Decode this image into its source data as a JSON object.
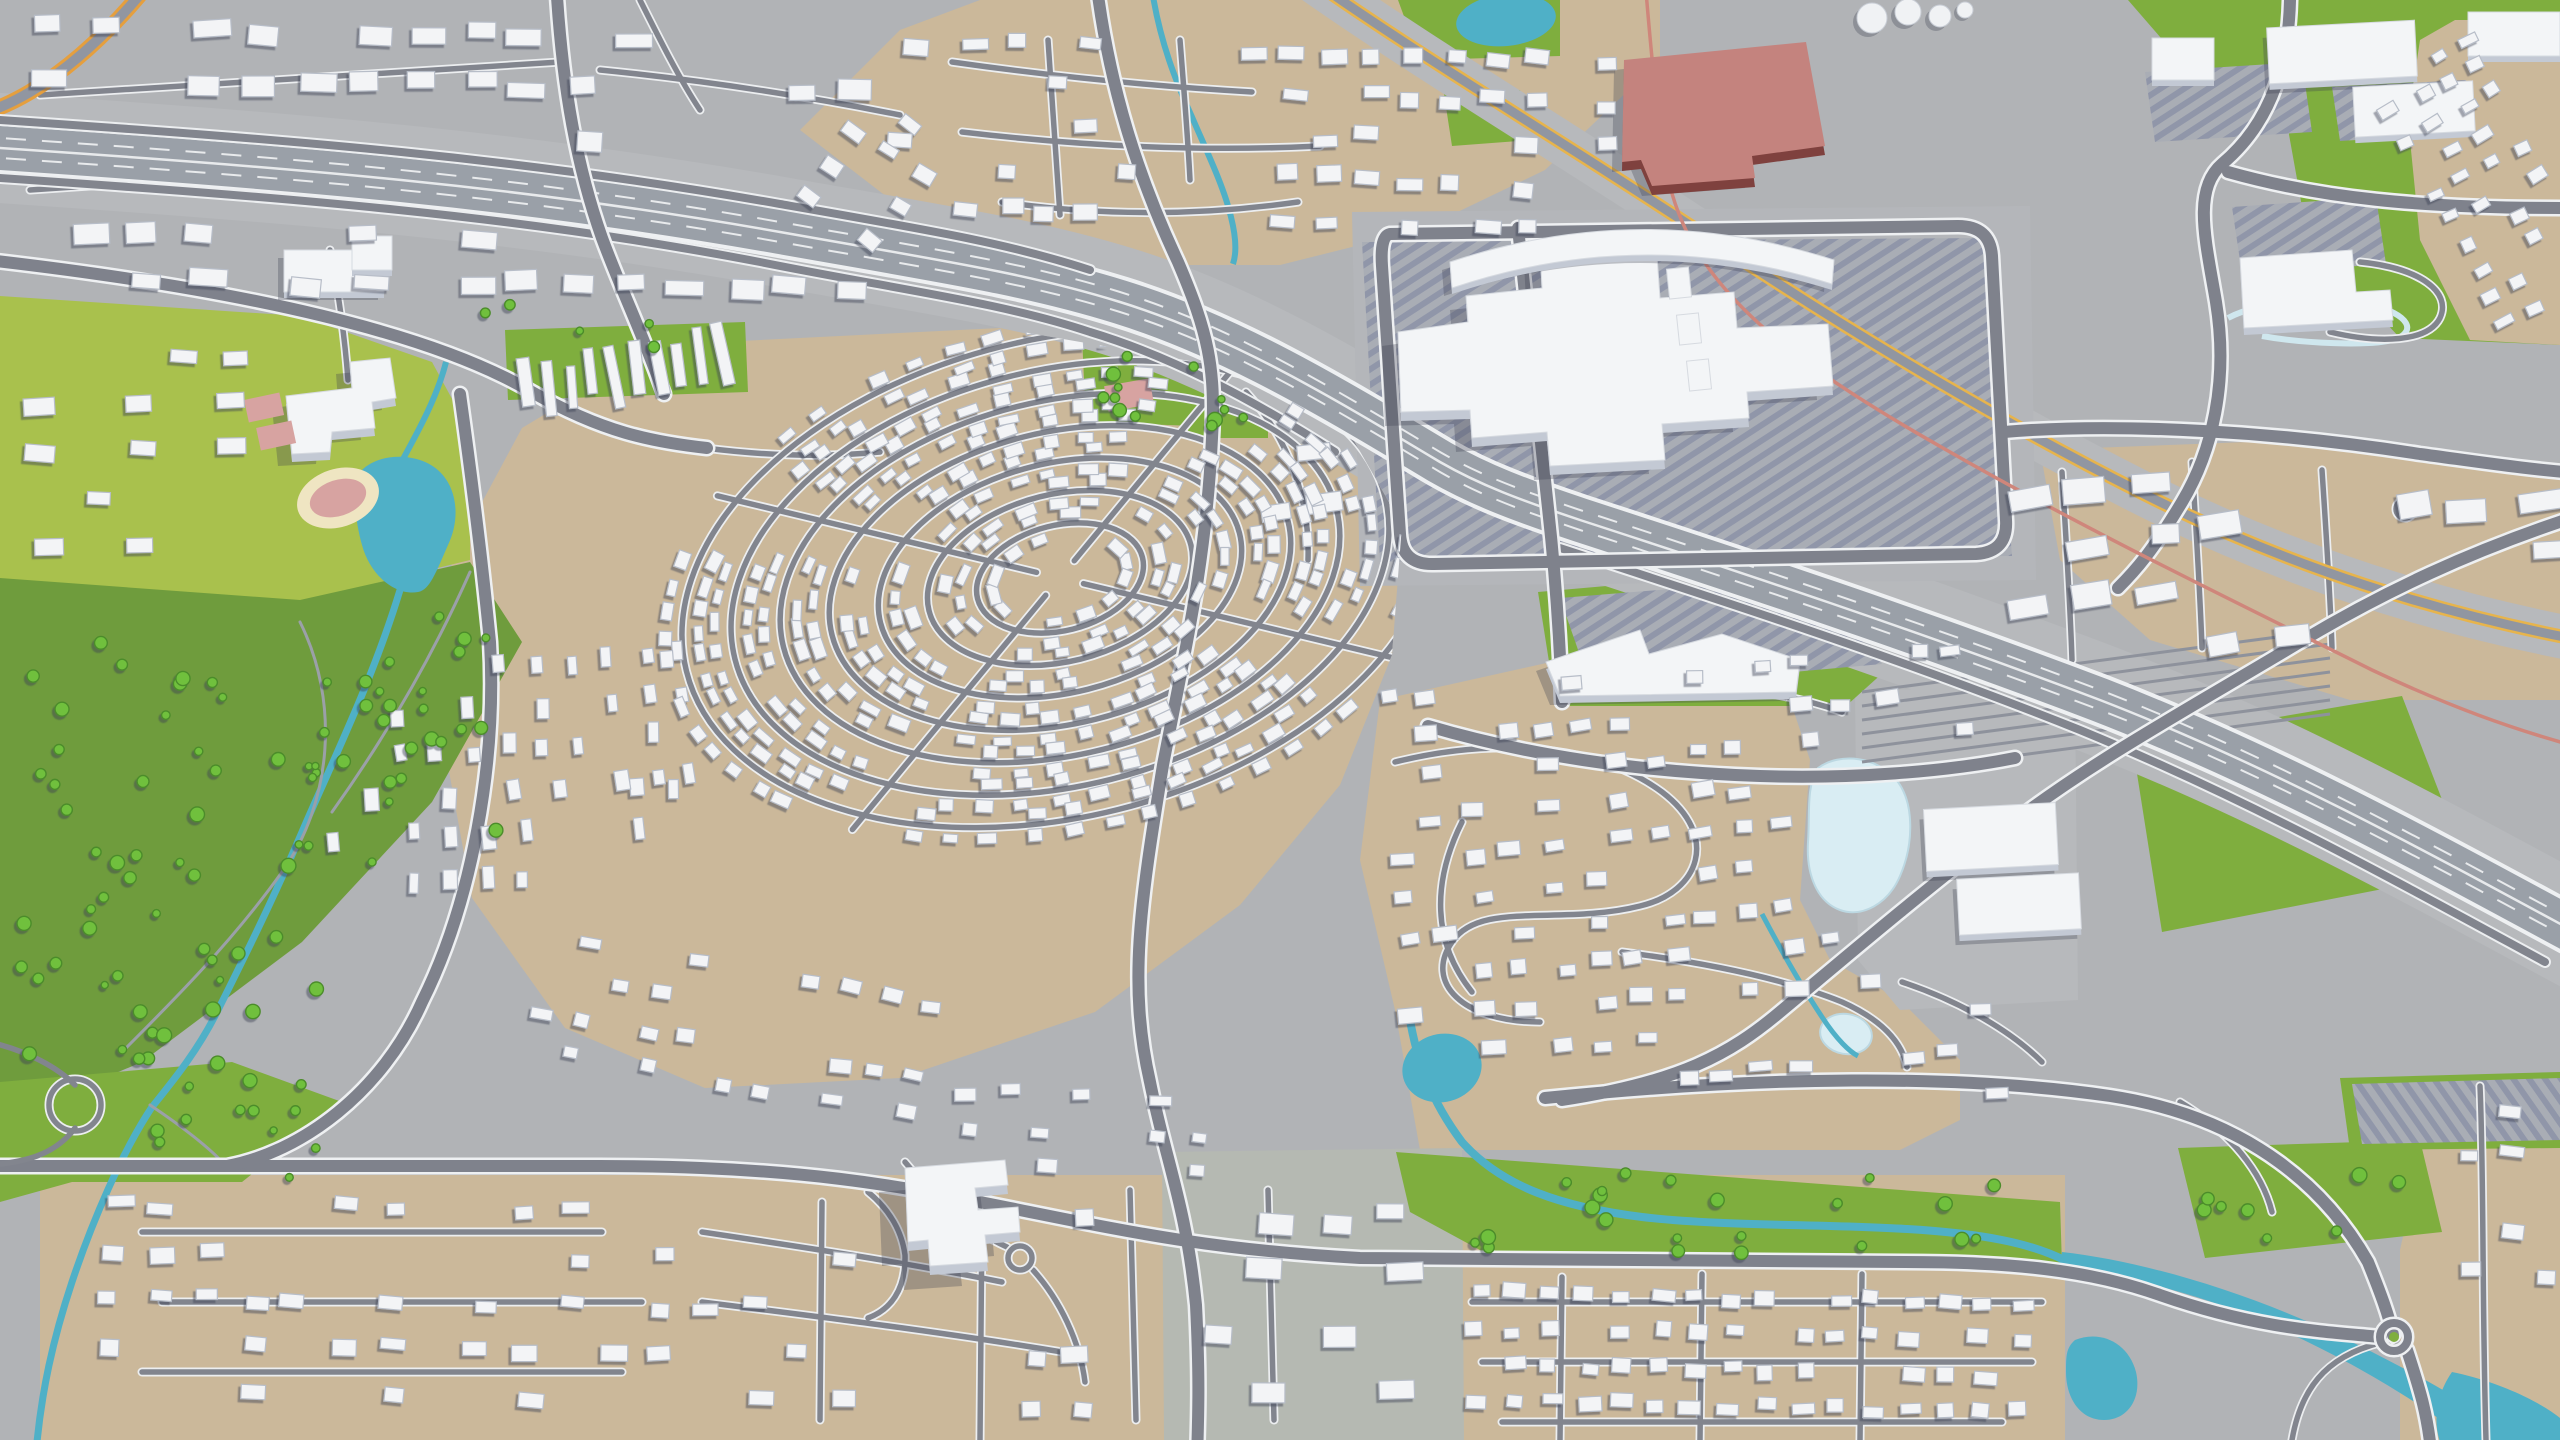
{
  "meta": {
    "description": "Aerial 3D render of a suburban city model: white extruded buildings, tan residential districts, a concentric-ring subdivision, green parks with ponds and streams, a diagonal multi-lane highway, rail corridor, shopping mall with striped parking lots and a red factory building",
    "width": 2560,
    "height": 1440,
    "view": "isometric-aerial"
  },
  "palette": {
    "ground": "#b1b3b6",
    "ground_cool": "#b5b9b2",
    "campus_pad": "#b4b6ba",
    "tan": "#cbb89a",
    "green_bright": "#a9c14d",
    "green_mid": "#7fae3e",
    "green_dark": "#6f9c3d",
    "tree": "#6fc03d",
    "tree_edge": "#4c8c2b",
    "water": "#4fb0c7",
    "water_pale": "#d9edf3",
    "road": "#7f828c",
    "road_casing": "#eef0f2",
    "highway_surface": "#9aa0a8",
    "yellow_stripe": "#e7b44c",
    "orange_stripe": "#e59f3e",
    "rail": "#cf867b",
    "building_top": "#f3f5f7",
    "building_side": "#c3c9d4",
    "red_roof": "#c4837e",
    "red_side": "#7f413e",
    "parking_stripe": "#9096a9",
    "track_ring": "#efe5c2",
    "track_infield": "#d7a3a1"
  },
  "landmarks": [
    "central-mall-building",
    "curved-strip-mall",
    "red-factory",
    "storage-tanks",
    "school-campus-west",
    "running-track",
    "tennis-courts",
    "school-campus-south",
    "warehouse-complex",
    "rail-yard",
    "big-box-stores-northeast",
    "retail-center-south",
    "ring-subdivision",
    "left-park",
    "creek-greenbelt",
    "roundabout-southeast",
    "highway-interchange",
    "top-left-tower-row"
  ],
  "zones": [
    {
      "name": "top-band",
      "x": 950,
      "y": 30,
      "w": 680,
      "h": 225,
      "ang": 2,
      "dx": 40,
      "dy": 42,
      "bw": 20,
      "bh": 13,
      "density": 0.6,
      "holes": [
        [
          1130,
          20,
          120,
          250
        ]
      ]
    },
    {
      "name": "right-suburb",
      "x": 1385,
      "y": 655,
      "w": 600,
      "h": 470,
      "ang": -5,
      "dx": 38,
      "dy": 40,
      "bw": 19,
      "bh": 12,
      "density": 0.62,
      "holes": [
        [
          1790,
          745,
          140,
          185
        ],
        [
          1805,
          985,
          100,
          90
        ],
        [
          1870,
          780,
          120,
          200
        ],
        [
          1385,
          1090,
          610,
          45
        ]
      ]
    },
    {
      "name": "bottom-left-band",
      "x": 90,
      "y": 1190,
      "w": 1060,
      "h": 240,
      "ang": 1,
      "dx": 46,
      "dy": 46,
      "bw": 21,
      "bh": 13,
      "density": 0.42,
      "holes": [
        [
          850,
          1150,
          230,
          175
        ]
      ]
    },
    {
      "name": "bottom-right-band",
      "x": 1460,
      "y": 1280,
      "w": 590,
      "h": 155,
      "ang": 1,
      "dx": 36,
      "dy": 36,
      "bw": 18,
      "bh": 12,
      "density": 0.8,
      "holes": []
    },
    {
      "name": "bottom-mid-blocks",
      "x": 1180,
      "y": 1190,
      "w": 270,
      "h": 240,
      "ang": 0,
      "dx": 62,
      "dy": 56,
      "bw": 30,
      "bh": 18,
      "density": 0.5,
      "holes": []
    },
    {
      "name": "top-right-corner",
      "x": 2420,
      "y": 30,
      "w": 135,
      "h": 300,
      "ang": -28,
      "dx": 33,
      "dy": 30,
      "bw": 15,
      "bh": 10,
      "density": 0.75,
      "holes": []
    },
    {
      "name": "right-edge-south",
      "x": 2445,
      "y": 1095,
      "w": 110,
      "h": 330,
      "ang": 3,
      "dx": 42,
      "dy": 40,
      "bw": 19,
      "bh": 12,
      "density": 0.55,
      "holes": [
        [
          2440,
          1280,
          130,
          170
        ]
      ]
    },
    {
      "name": "top-left-urban",
      "x": 15,
      "y": 10,
      "w": 930,
      "h": 290,
      "ang": 1,
      "dx": 54,
      "dy": 50,
      "bw": 30,
      "bh": 16,
      "density": 0.5,
      "holes": [
        [
          0,
          118,
          560,
          84
        ],
        [
          540,
          162,
          430,
          116
        ]
      ]
    },
    {
      "name": "left-mid-urban",
      "x": 20,
      "y": 335,
      "w": 230,
      "h": 230,
      "ang": 0,
      "dx": 48,
      "dy": 46,
      "bw": 26,
      "bh": 14,
      "density": 0.5,
      "holes": []
    },
    {
      "name": "park-east-strip",
      "x": 455,
      "y": 640,
      "w": 110,
      "h": 370,
      "ang": 88,
      "dx": 42,
      "dy": 38,
      "bw": 18,
      "bh": 11,
      "density": 0.65,
      "holes": []
    },
    {
      "name": "right-offices",
      "x": 2000,
      "y": 440,
      "w": 560,
      "h": 250,
      "ang": -6,
      "dx": 64,
      "dy": 56,
      "bw": 34,
      "bh": 20,
      "density": 0.42,
      "holes": [
        [
          2240,
          370,
          120,
          110
        ]
      ]
    },
    {
      "name": "slab-row",
      "x": 515,
      "y": 336,
      "w": 225,
      "h": 60,
      "ang": -8,
      "dx": 22,
      "dy": 70,
      "bw": 10,
      "bh": 50,
      "density": 1,
      "holes": []
    },
    {
      "name": "ring-west",
      "x": 460,
      "y": 560,
      "w": 160,
      "h": 330,
      "ang": 85,
      "dx": 40,
      "dy": 36,
      "bw": 17,
      "bh": 11,
      "density": 0.55,
      "holes": []
    },
    {
      "name": "ring-south",
      "x": 520,
      "y": 950,
      "w": 420,
      "h": 160,
      "ang": 10,
      "dx": 38,
      "dy": 38,
      "bw": 17,
      "bh": 11,
      "density": 0.6,
      "holes": []
    },
    {
      "name": "ring-southeast",
      "x": 950,
      "y": 1080,
      "w": 260,
      "h": 90,
      "ang": 3,
      "dx": 38,
      "dy": 34,
      "bw": 17,
      "bh": 11,
      "density": 0.55,
      "holes": []
    },
    {
      "name": "top-center-west",
      "x": 815,
      "y": 95,
      "w": 140,
      "h": 160,
      "ang": 35,
      "dx": 40,
      "dy": 40,
      "bw": 18,
      "bh": 12,
      "density": 0.6,
      "holes": []
    },
    {
      "name": "mall-east-offices",
      "x": 1235,
      "y": 380,
      "w": 130,
      "h": 190,
      "ang": -10,
      "dx": 56,
      "dy": 52,
      "bw": 28,
      "bh": 17,
      "density": 0.5,
      "holes": []
    }
  ],
  "ring": {
    "cx": 1060,
    "cy": 578,
    "rot": -14,
    "squash": 0.62,
    "rings": [
      85,
      135,
      185,
      235,
      285,
      335,
      385
    ],
    "step": 31,
    "off": 17,
    "bw": 16,
    "bh": 10,
    "spokes": [
      40,
      130,
      220,
      310
    ],
    "gap": 8,
    "holes": [
      [
        1180,
        380,
        100,
        70
      ]
    ],
    "clip": "660,345 1000,328 1230,368 1345,425 1402,525 1392,655 1340,785 1240,905 1095,1012 900,1078 705,1088 565,1028 472,898 443,738 452,558 522,428"
  },
  "trees": [
    [
      20,
      620,
      300,
      450,
      55
    ],
    [
      300,
      615,
      210,
      250,
      26
    ],
    [
      140,
      1060,
      200,
      120,
      13
    ],
    [
      1435,
      1165,
      600,
      90,
      22
    ],
    [
      1090,
      350,
      110,
      70,
      8
    ],
    [
      2180,
      1150,
      230,
      100,
      8
    ],
    [
      460,
      300,
      200,
      60,
      5
    ],
    [
      1190,
      392,
      80,
      50,
      5
    ]
  ],
  "tree_holes": [
    [
      350,
      448,
      118,
      150
    ]
  ],
  "water_features": [
    "west-pond",
    "west-stream",
    "north-creek",
    "factory-pond",
    "frozen-pond-east",
    "frozen-pond-small",
    "greenbelt-creek",
    "greenbelt-pond",
    "southeast-river",
    "southeast-pond",
    "corner-lake",
    "lazy-canal"
  ]
}
